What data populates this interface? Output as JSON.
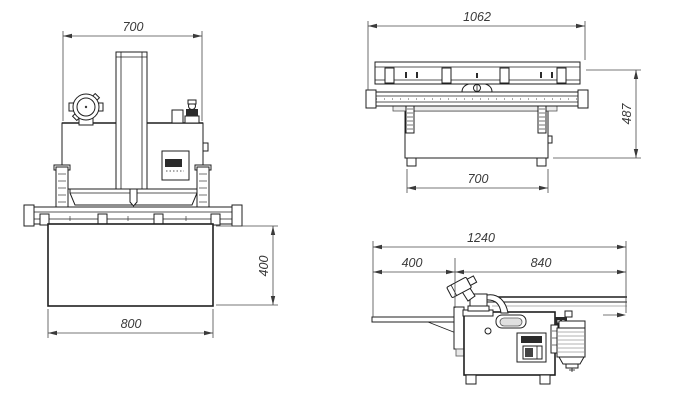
{
  "drawing": {
    "type": "technical-three-view-drawing",
    "subject": "woodworking machine overall dimensions",
    "units": "mm",
    "line_color": "#1f1f1f",
    "dimension_color": "#3a3a3a",
    "views": {
      "front": {
        "name": "front-view",
        "dims": {
          "top_width": "700",
          "base_width": "800",
          "base_height": "400"
        }
      },
      "rear": {
        "name": "rear-view",
        "dims": {
          "overall_width": "1062",
          "overall_height": "487",
          "body_width": "700"
        }
      },
      "side": {
        "name": "side-view",
        "dims": {
          "overall_length": "1240",
          "left_segment": "400",
          "right_segment": "840"
        }
      }
    }
  }
}
